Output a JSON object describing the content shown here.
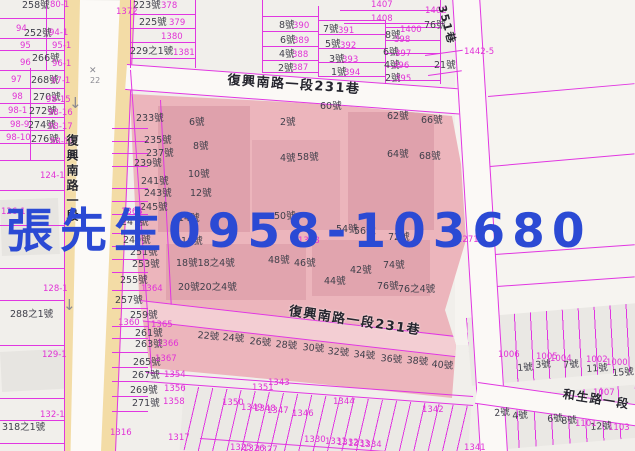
{
  "overlay": {
    "text": "張先生0958-103680",
    "color": "#2b4ad4"
  },
  "roads": {
    "main_road": "復興南路一段",
    "lane_top": "復興南路一段231巷",
    "lane_bottom": "復興南路一段231巷",
    "hesheng_road": "和生路一段",
    "alley_ne": "351巷"
  },
  "streets": [
    {
      "t": "復興南路一段231巷",
      "x": 228,
      "y": 74,
      "r": 4,
      "s": 13
    },
    {
      "t": "復興南路一段231巷",
      "x": 290,
      "y": 305,
      "r": 8.5,
      "s": 13
    },
    {
      "t": "和生路一段",
      "x": 564,
      "y": 388,
      "r": 9,
      "s": 12
    },
    {
      "t": "351巷",
      "x": 447,
      "y": 4,
      "r": 75,
      "s": 11
    },
    {
      "t": "復興南路一段",
      "x": 66,
      "y": 134,
      "r": 0,
      "s": 12,
      "v": true
    }
  ],
  "symbols": [
    {
      "t": "✕",
      "x": 89,
      "y": 67,
      "s": 9
    },
    {
      "t": "22",
      "x": 90,
      "y": 77,
      "s": 8
    },
    {
      "t": "↓",
      "x": 69,
      "y": 96,
      "s": 15
    },
    {
      "t": "↓",
      "x": 63,
      "y": 298,
      "s": 15
    }
  ],
  "labels": {
    "house": [
      {
        "t": "258號",
        "x": 22,
        "y": 1
      },
      {
        "t": "252號",
        "x": 24,
        "y": 29
      },
      {
        "t": "266號",
        "x": 32,
        "y": 54
      },
      {
        "t": "268號",
        "x": 31,
        "y": 76
      },
      {
        "t": "270號",
        "x": 33,
        "y": 93
      },
      {
        "t": "272號",
        "x": 29,
        "y": 107
      },
      {
        "t": "274號",
        "x": 28,
        "y": 121
      },
      {
        "t": "276號",
        "x": 31,
        "y": 135
      },
      {
        "t": "288之1號",
        "x": 10,
        "y": 310
      },
      {
        "t": "318之1號",
        "x": 2,
        "y": 423
      },
      {
        "t": "233號",
        "x": 136,
        "y": 114
      },
      {
        "t": "235號",
        "x": 144,
        "y": 136
      },
      {
        "t": "237號",
        "x": 146,
        "y": 149
      },
      {
        "t": "239號",
        "x": 134,
        "y": 159
      },
      {
        "t": "241號",
        "x": 141,
        "y": 177
      },
      {
        "t": "243號",
        "x": 144,
        "y": 189
      },
      {
        "t": "245號",
        "x": 140,
        "y": 203
      },
      {
        "t": "247號",
        "x": 121,
        "y": 218
      },
      {
        "t": "249號",
        "x": 123,
        "y": 236
      },
      {
        "t": "251號",
        "x": 130,
        "y": 248
      },
      {
        "t": "253號",
        "x": 132,
        "y": 260
      },
      {
        "t": "255號",
        "x": 120,
        "y": 276
      },
      {
        "t": "257號",
        "x": 115,
        "y": 296
      },
      {
        "t": "259號",
        "x": 130,
        "y": 311
      },
      {
        "t": "261號",
        "x": 135,
        "y": 329
      },
      {
        "t": "263號",
        "x": 135,
        "y": 340
      },
      {
        "t": "265號",
        "x": 133,
        "y": 358
      },
      {
        "t": "267號",
        "x": 132,
        "y": 371
      },
      {
        "t": "269號",
        "x": 130,
        "y": 386
      },
      {
        "t": "271號",
        "x": 132,
        "y": 399
      },
      {
        "t": "6號",
        "x": 189,
        "y": 118
      },
      {
        "t": "8號",
        "x": 193,
        "y": 142
      },
      {
        "t": "10號",
        "x": 188,
        "y": 170
      },
      {
        "t": "12號",
        "x": 190,
        "y": 189
      },
      {
        "t": "14號",
        "x": 178,
        "y": 214
      },
      {
        "t": "16號",
        "x": 181,
        "y": 237
      },
      {
        "t": "18號18之4號",
        "x": 176,
        "y": 259
      },
      {
        "t": "20號20之4號",
        "x": 178,
        "y": 283
      },
      {
        "t": "2號",
        "x": 280,
        "y": 118
      },
      {
        "t": "4號",
        "x": 280,
        "y": 154
      },
      {
        "t": "58號",
        "x": 297,
        "y": 153
      },
      {
        "t": "60號",
        "x": 320,
        "y": 102
      },
      {
        "t": "62號",
        "x": 387,
        "y": 112
      },
      {
        "t": "66號",
        "x": 421,
        "y": 116
      },
      {
        "t": "64號",
        "x": 387,
        "y": 150
      },
      {
        "t": "68號",
        "x": 419,
        "y": 152
      },
      {
        "t": "50號",
        "x": 274,
        "y": 212
      },
      {
        "t": "54號",
        "x": 336,
        "y": 225
      },
      {
        "t": "56號",
        "x": 354,
        "y": 227
      },
      {
        "t": "72號",
        "x": 388,
        "y": 233
      },
      {
        "t": "48號",
        "x": 268,
        "y": 256
      },
      {
        "t": "46號",
        "x": 294,
        "y": 259
      },
      {
        "t": "44號",
        "x": 324,
        "y": 277
      },
      {
        "t": "42號",
        "x": 350,
        "y": 266
      },
      {
        "t": "74號",
        "x": 383,
        "y": 261
      },
      {
        "t": "76號",
        "x": 377,
        "y": 282
      },
      {
        "t": "76之4號",
        "x": 398,
        "y": 285
      },
      {
        "t": "22號",
        "x": 198,
        "y": 331,
        "r": 5
      },
      {
        "t": "24號",
        "x": 223,
        "y": 333,
        "r": 5
      },
      {
        "t": "26號",
        "x": 250,
        "y": 337,
        "r": 5
      },
      {
        "t": "28號",
        "x": 276,
        "y": 340,
        "r": 5
      },
      {
        "t": "30號",
        "x": 303,
        "y": 343,
        "r": 5
      },
      {
        "t": "32號",
        "x": 328,
        "y": 347,
        "r": 5
      },
      {
        "t": "34號",
        "x": 354,
        "y": 350,
        "r": 5
      },
      {
        "t": "36號",
        "x": 381,
        "y": 354,
        "r": 5
      },
      {
        "t": "38號",
        "x": 407,
        "y": 356,
        "r": 5
      },
      {
        "t": "40號",
        "x": 432,
        "y": 360,
        "r": 5
      },
      {
        "t": "223號",
        "x": 133,
        "y": 1
      },
      {
        "t": "225號",
        "x": 139,
        "y": 18
      },
      {
        "t": "229之1號",
        "x": 130,
        "y": 47
      },
      {
        "t": "8號",
        "x": 279,
        "y": 21
      },
      {
        "t": "6號",
        "x": 280,
        "y": 36
      },
      {
        "t": "4號",
        "x": 279,
        "y": 50
      },
      {
        "t": "2號",
        "x": 278,
        "y": 64
      },
      {
        "t": "7號",
        "x": 323,
        "y": 25
      },
      {
        "t": "5號",
        "x": 325,
        "y": 40
      },
      {
        "t": "3號",
        "x": 329,
        "y": 55
      },
      {
        "t": "1號",
        "x": 331,
        "y": 68
      },
      {
        "t": "8號",
        "x": 385,
        "y": 31
      },
      {
        "t": "6號",
        "x": 383,
        "y": 48
      },
      {
        "t": "4號",
        "x": 384,
        "y": 61
      },
      {
        "t": "2號",
        "x": 385,
        "y": 74
      },
      {
        "t": "76號",
        "x": 424,
        "y": 21
      },
      {
        "t": "21號",
        "x": 434,
        "y": 61
      },
      {
        "t": "1號",
        "x": 517,
        "y": 364,
        "r": -4
      },
      {
        "t": "3號",
        "x": 535,
        "y": 361,
        "r": -4
      },
      {
        "t": "7號",
        "x": 563,
        "y": 361,
        "r": -4
      },
      {
        "t": "11號",
        "x": 586,
        "y": 365,
        "r": -4
      },
      {
        "t": "15號",
        "x": 612,
        "y": 369,
        "r": -4
      },
      {
        "t": "2號",
        "x": 494,
        "y": 409,
        "r": -4
      },
      {
        "t": "4號",
        "x": 512,
        "y": 412,
        "r": -4
      },
      {
        "t": "6號",
        "x": 547,
        "y": 415,
        "r": -4
      },
      {
        "t": "8號",
        "x": 561,
        "y": 417,
        "r": -4
      },
      {
        "t": "12號",
        "x": 590,
        "y": 423,
        "r": -4
      }
    ],
    "lot": [
      {
        "t": "80-1",
        "x": 50,
        "y": 1
      },
      {
        "t": "94",
        "x": 16,
        "y": 25
      },
      {
        "t": "94-1",
        "x": 49,
        "y": 29
      },
      {
        "t": "95",
        "x": 20,
        "y": 42
      },
      {
        "t": "95-1",
        "x": 52,
        "y": 42
      },
      {
        "t": "96",
        "x": 20,
        "y": 59
      },
      {
        "t": "96-1",
        "x": 52,
        "y": 60
      },
      {
        "t": "97",
        "x": 11,
        "y": 76
      },
      {
        "t": "97-1",
        "x": 51,
        "y": 77
      },
      {
        "t": "98",
        "x": 12,
        "y": 93
      },
      {
        "t": "98-15",
        "x": 46,
        "y": 96
      },
      {
        "t": "98-1",
        "x": 8,
        "y": 107
      },
      {
        "t": "98-16",
        "x": 48,
        "y": 109
      },
      {
        "t": "98-9",
        "x": 10,
        "y": 121
      },
      {
        "t": "98-17",
        "x": 48,
        "y": 123
      },
      {
        "t": "98-10",
        "x": 6,
        "y": 134
      },
      {
        "t": "98-18",
        "x": 50,
        "y": 138
      },
      {
        "t": "124-1",
        "x": 40,
        "y": 172
      },
      {
        "t": "126-1",
        "x": 1,
        "y": 208
      },
      {
        "t": "128-1",
        "x": 43,
        "y": 285
      },
      {
        "t": "129-1",
        "x": 42,
        "y": 351
      },
      {
        "t": "132-1",
        "x": 40,
        "y": 411
      },
      {
        "t": "378",
        "x": 161,
        "y": 2
      },
      {
        "t": "379",
        "x": 169,
        "y": 19
      },
      {
        "t": "1380",
        "x": 161,
        "y": 33
      },
      {
        "t": "1381",
        "x": 173,
        "y": 49
      },
      {
        "t": "1372",
        "x": 116,
        "y": 8
      },
      {
        "t": "390",
        "x": 293,
        "y": 22
      },
      {
        "t": "389",
        "x": 293,
        "y": 37
      },
      {
        "t": "388",
        "x": 292,
        "y": 51
      },
      {
        "t": "387",
        "x": 292,
        "y": 64
      },
      {
        "t": "391",
        "x": 338,
        "y": 27
      },
      {
        "t": "392",
        "x": 340,
        "y": 42
      },
      {
        "t": "393",
        "x": 342,
        "y": 56
      },
      {
        "t": "394",
        "x": 344,
        "y": 69
      },
      {
        "t": "1400",
        "x": 400,
        "y": 26
      },
      {
        "t": "398",
        "x": 394,
        "y": 36
      },
      {
        "t": "397",
        "x": 395,
        "y": 50
      },
      {
        "t": "396",
        "x": 393,
        "y": 62
      },
      {
        "t": "395",
        "x": 395,
        "y": 75
      },
      {
        "t": "1407",
        "x": 371,
        "y": 1
      },
      {
        "t": "1408",
        "x": 371,
        "y": 15
      },
      {
        "t": "1402",
        "x": 425,
        "y": 7
      },
      {
        "t": "1442-5",
        "x": 464,
        "y": 48
      },
      {
        "t": "1271",
        "x": 457,
        "y": 236
      },
      {
        "t": "1363",
        "x": 121,
        "y": 208
      },
      {
        "t": "1364",
        "x": 141,
        "y": 285
      },
      {
        "t": "1368",
        "x": 298,
        "y": 237
      },
      {
        "t": "1360",
        "x": 118,
        "y": 319
      },
      {
        "t": "1316",
        "x": 110,
        "y": 429
      },
      {
        "t": "1317",
        "x": 168,
        "y": 434
      },
      {
        "t": "1365",
        "x": 151,
        "y": 321
      },
      {
        "t": "1366",
        "x": 157,
        "y": 340
      },
      {
        "t": "1367",
        "x": 155,
        "y": 355
      },
      {
        "t": "1354",
        "x": 164,
        "y": 371
      },
      {
        "t": "1356",
        "x": 164,
        "y": 385
      },
      {
        "t": "1358",
        "x": 163,
        "y": 398
      },
      {
        "t": "1343",
        "x": 268,
        "y": 379
      },
      {
        "t": "1351",
        "x": 252,
        "y": 384
      },
      {
        "t": "1350",
        "x": 222,
        "y": 399
      },
      {
        "t": "1349",
        "x": 241,
        "y": 404
      },
      {
        "t": "1348",
        "x": 254,
        "y": 405
      },
      {
        "t": "1347",
        "x": 267,
        "y": 407
      },
      {
        "t": "1346",
        "x": 292,
        "y": 410
      },
      {
        "t": "1344",
        "x": 333,
        "y": 398
      },
      {
        "t": "1342",
        "x": 422,
        "y": 406
      },
      {
        "t": "1341",
        "x": 464,
        "y": 444
      },
      {
        "t": "1330",
        "x": 304,
        "y": 436
      },
      {
        "t": "1331",
        "x": 325,
        "y": 438
      },
      {
        "t": "1332",
        "x": 337,
        "y": 439
      },
      {
        "t": "1333",
        "x": 348,
        "y": 440
      },
      {
        "t": "1334",
        "x": 360,
        "y": 441
      },
      {
        "t": "1325",
        "x": 230,
        "y": 444
      },
      {
        "t": "1326",
        "x": 243,
        "y": 445
      },
      {
        "t": "1327",
        "x": 256,
        "y": 446
      },
      {
        "t": "1006",
        "x": 498,
        "y": 351
      },
      {
        "t": "1005",
        "x": 536,
        "y": 353
      },
      {
        "t": "1004",
        "x": 550,
        "y": 355
      },
      {
        "t": "1002",
        "x": 586,
        "y": 356
      },
      {
        "t": "1000",
        "x": 606,
        "y": 359
      },
      {
        "t": "1007",
        "x": 593,
        "y": 389
      },
      {
        "t": "1101",
        "x": 575,
        "y": 420
      },
      {
        "t": "1103",
        "x": 608,
        "y": 424
      }
    ]
  }
}
